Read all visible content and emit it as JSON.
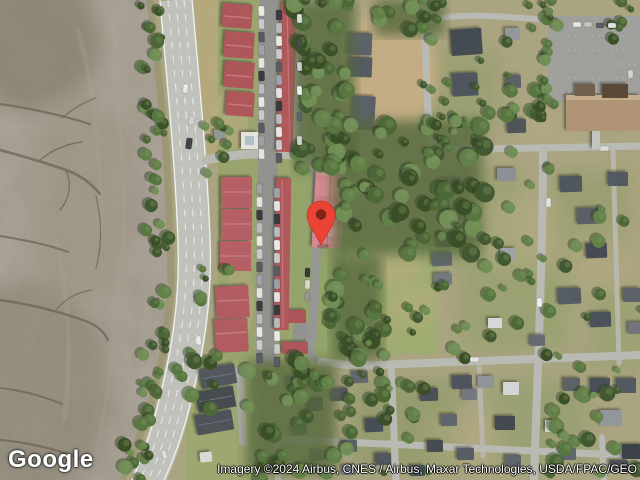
{
  "logo": {
    "text": "Google"
  },
  "map": {
    "attribution": "Imagery ©2024 Airbus, CNES / Airbus, Maxar Technologies, USDA/FPAC/GEO",
    "pin_color": "#EA4335",
    "pin_inner_color": "#7E2217"
  }
}
